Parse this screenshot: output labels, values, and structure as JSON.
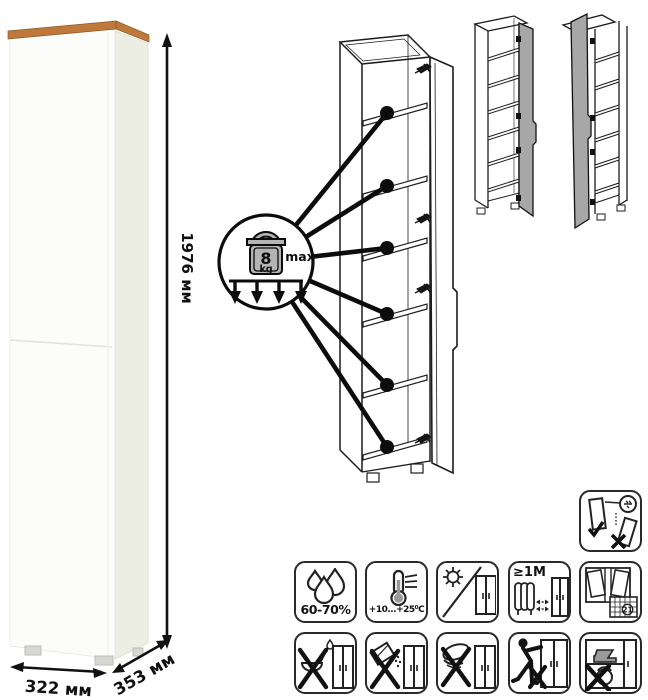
{
  "dimensions": {
    "height": "1976 мм",
    "width": "322 мм",
    "depth": "353 мм"
  },
  "load_limit": {
    "value": "8",
    "unit": "kg",
    "qualifier": "max"
  },
  "care_labels": {
    "humidity": "60-70%",
    "temperature": "+10...+25⁰C",
    "heat_distance": "≥1М",
    "ventilation_day": "21"
  },
  "icon_names": {
    "humidity-icon": "water-drops",
    "temperature-icon": "thermometer",
    "no-direct-sunlight-icon": "sun-slash-cabinet",
    "heat-distance-icon": "radiator-keep-1m",
    "ventilation-icon": "open-window-calendar",
    "wall-anchor-icon": "secure-cabinet-to-wall",
    "no-liquids-icon": "crossed-ladle-liquid",
    "no-abrasives-icon": "crossed-powder-box",
    "no-wet-sponge-icon": "crossed-wet-sponge",
    "no-dragging-icon": "crossed-person-dragging",
    "no-overload-icon": "crossed-heavy-load"
  },
  "colors": {
    "wood_top": "#c0793c",
    "door_gray": "#a7a7a7",
    "weight_gray": "#b5b5b5",
    "line": "#1c1c1c"
  }
}
